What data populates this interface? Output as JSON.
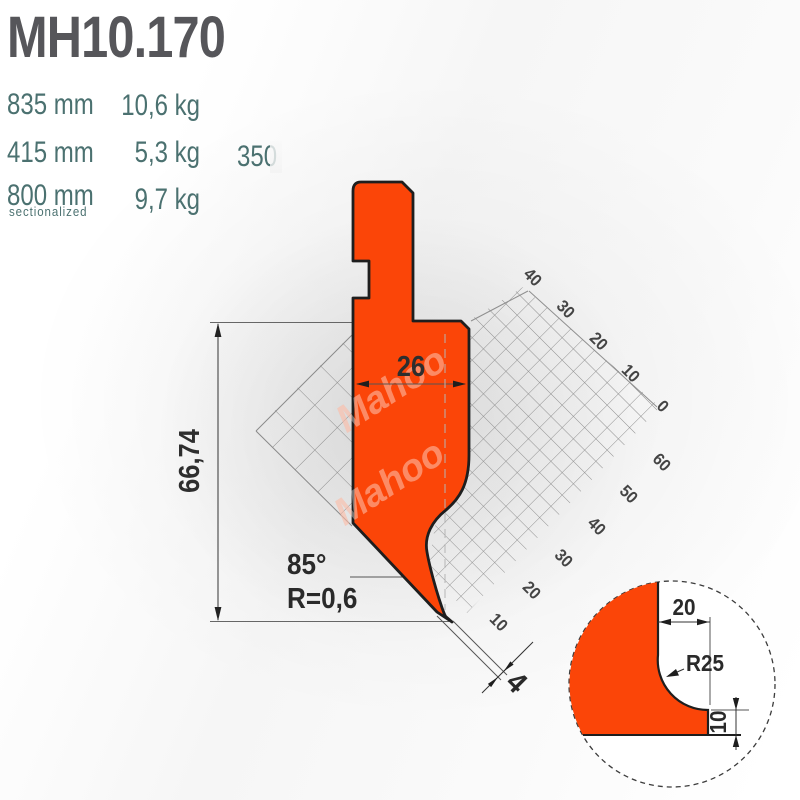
{
  "page": {
    "model": "MH10.170"
  },
  "specs": {
    "rows": [
      {
        "length": "835 mm",
        "weight": "10,6 kg"
      },
      {
        "length": "415 mm",
        "weight": "5,3 kg",
        "side_value": "350"
      },
      {
        "length": "800 mm",
        "length_note": "sectionalized",
        "weight": "9,7 kg"
      }
    ]
  },
  "drawing": {
    "dim_body_width": "26",
    "dim_height": "66,74",
    "dim_tip_angle": "85°",
    "dim_tip_radius": "R=0,6",
    "dim_tip_width": "4",
    "grid_labels_upper": [
      "40",
      "30",
      "20",
      "10",
      "0"
    ],
    "grid_labels_lower": [
      "60",
      "50",
      "40",
      "30",
      "20",
      "10"
    ],
    "watermark": "Mahoo",
    "detail": {
      "dim_top_width": "20",
      "dim_radius": "R25",
      "dim_bottom_height": "10"
    },
    "colors": {
      "punch_fill": "#fb4508",
      "outline": "#1e1e1e",
      "accent_teal": "#4b7170",
      "title_gray": "#56565a"
    }
  }
}
